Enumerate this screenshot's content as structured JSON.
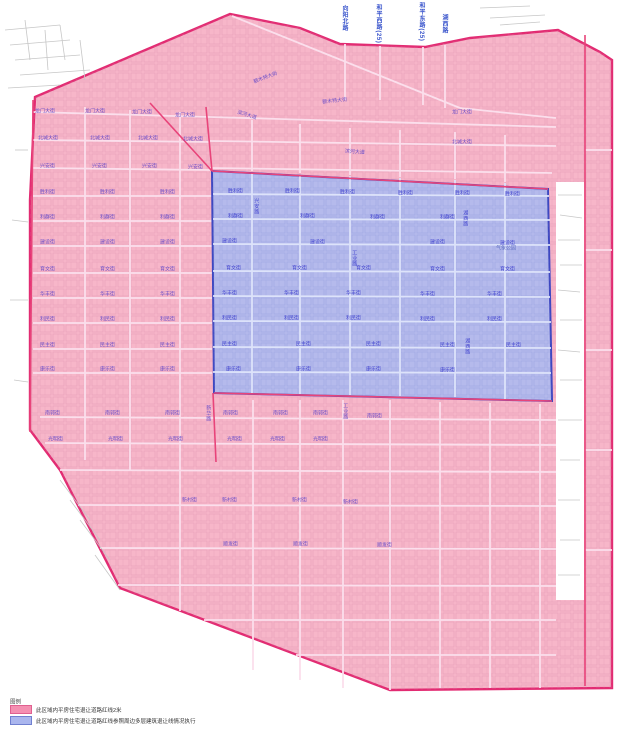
{
  "legend": {
    "title": "图例",
    "items": [
      {
        "label": "此区域内平房住宅退让道路红线2米",
        "color": "#f48fb1",
        "border": "#e06090"
      },
      {
        "label": "此区域内平房住宅退让道路红线参照周边多层建筑退让线情况执行",
        "color": "#aab6ee",
        "border": "#7080d0"
      }
    ]
  },
  "map": {
    "colors": {
      "pink_fill": "#f7b6c9",
      "pink_border": "#e22b72",
      "blue_fill": "#b0bbf0",
      "blue_border": "#2e3ec0",
      "street_label": "#6b4fc8",
      "blue_street_label": "#4345cf",
      "top_road_label": "#3a55cc"
    },
    "regions": {
      "pink_outline": "35,97 230,14 300,28 340,44 425,47 470,38 558,30 600,52 612,60 612,688 390,690 120,588 60,470 30,430 30,200",
      "blue_outline": "212,171 548,189 552,401 214,393",
      "white_notch": "556,182 584,182 584,600 556,600"
    },
    "lines": [
      [
        150,
        103,
        212,
        171,
        "r"
      ],
      [
        212,
        171,
        548,
        189,
        "r"
      ],
      [
        214,
        393,
        552,
        401,
        "r"
      ],
      [
        33,
        100,
        30,
        432,
        "r"
      ],
      [
        206,
        107,
        212,
        171,
        "r"
      ],
      [
        213,
        393,
        216,
        462,
        "r"
      ],
      [
        585,
        35,
        585,
        686,
        "r"
      ],
      [
        232,
        16,
        460,
        108,
        "p"
      ],
      [
        460,
        108,
        556,
        118,
        "p"
      ],
      [
        33,
        112,
        210,
        117,
        "p"
      ],
      [
        210,
        117,
        556,
        127,
        "p"
      ],
      [
        33,
        140,
        210,
        142,
        "p"
      ],
      [
        210,
        141,
        556,
        146,
        "p"
      ],
      [
        33,
        168,
        210,
        170,
        "p"
      ],
      [
        210,
        168,
        552,
        173,
        "p"
      ],
      [
        33,
        196,
        212,
        196,
        "p"
      ],
      [
        33,
        221,
        212,
        221,
        "p"
      ],
      [
        33,
        246,
        212,
        246,
        "p"
      ],
      [
        33,
        273,
        212,
        273,
        "p"
      ],
      [
        33,
        298,
        212,
        298,
        "p"
      ],
      [
        33,
        323,
        212,
        323,
        "p"
      ],
      [
        33,
        349,
        212,
        349,
        "p"
      ],
      [
        33,
        373,
        212,
        373,
        "p"
      ],
      [
        40,
        417,
        556,
        420,
        "p"
      ],
      [
        45,
        443,
        556,
        445,
        "p"
      ],
      [
        60,
        470,
        556,
        472,
        "p"
      ],
      [
        78,
        505,
        556,
        506,
        "p"
      ],
      [
        100,
        548,
        556,
        549,
        "p"
      ],
      [
        118,
        585,
        556,
        586,
        "p"
      ],
      [
        204,
        620,
        556,
        620,
        "p"
      ],
      [
        296,
        655,
        556,
        655,
        "p"
      ],
      [
        85,
        107,
        85,
        460,
        "p"
      ],
      [
        130,
        110,
        130,
        470,
        "p"
      ],
      [
        180,
        112,
        180,
        611,
        "p"
      ],
      [
        345,
        44,
        345,
        100,
        "p"
      ],
      [
        380,
        46,
        380,
        100,
        "p"
      ],
      [
        423,
        47,
        423,
        105,
        "p"
      ],
      [
        445,
        45,
        445,
        108,
        "p"
      ],
      [
        252,
        120,
        252,
        171,
        "p"
      ],
      [
        300,
        124,
        300,
        173,
        "p"
      ],
      [
        350,
        128,
        350,
        175,
        "p"
      ],
      [
        400,
        130,
        400,
        177,
        "p"
      ],
      [
        455,
        132,
        455,
        179,
        "p"
      ],
      [
        505,
        135,
        505,
        182,
        "p"
      ],
      [
        253,
        400,
        253,
        670,
        "p"
      ],
      [
        300,
        400,
        300,
        680,
        "p"
      ],
      [
        343,
        400,
        343,
        688,
        "p"
      ],
      [
        390,
        400,
        390,
        690,
        "p"
      ],
      [
        440,
        402,
        440,
        688,
        "p"
      ],
      [
        490,
        403,
        490,
        688,
        "p"
      ],
      [
        540,
        404,
        540,
        688,
        "p"
      ],
      [
        585,
        150,
        612,
        150,
        "p"
      ],
      [
        585,
        250,
        612,
        250,
        "p"
      ],
      [
        585,
        350,
        612,
        350,
        "p"
      ],
      [
        585,
        450,
        612,
        450,
        "p"
      ],
      [
        585,
        550,
        612,
        550,
        "p"
      ],
      [
        213,
        194,
        549,
        196,
        "b"
      ],
      [
        213,
        219,
        550,
        220,
        "b"
      ],
      [
        213,
        244,
        550,
        245,
        "b"
      ],
      [
        213,
        271,
        550,
        272,
        "b"
      ],
      [
        213,
        296,
        550,
        297,
        "b"
      ],
      [
        213,
        321,
        551,
        322,
        "b"
      ],
      [
        213,
        347,
        551,
        348,
        "b"
      ],
      [
        213,
        372,
        551,
        373,
        "b"
      ],
      [
        252,
        173,
        252,
        393,
        "b"
      ],
      [
        300,
        175,
        300,
        394,
        "b"
      ],
      [
        350,
        176,
        350,
        395,
        "b"
      ],
      [
        400,
        178,
        400,
        396,
        "b"
      ],
      [
        455,
        180,
        455,
        397,
        "b"
      ],
      [
        505,
        183,
        505,
        399,
        "b"
      ],
      [
        5,
        30,
        60,
        25,
        "g"
      ],
      [
        10,
        45,
        70,
        40,
        "g"
      ],
      [
        15,
        60,
        80,
        55,
        "g"
      ],
      [
        20,
        75,
        90,
        70,
        "g"
      ],
      [
        8,
        88,
        60,
        85,
        "g"
      ],
      [
        60,
        25,
        65,
        60,
        "g"
      ],
      [
        80,
        40,
        85,
        80,
        "g"
      ],
      [
        25,
        20,
        30,
        60,
        "g"
      ],
      [
        45,
        30,
        48,
        70,
        "g"
      ],
      [
        15,
        150,
        28,
        150,
        "g"
      ],
      [
        12,
        220,
        28,
        222,
        "g"
      ],
      [
        10,
        300,
        28,
        300,
        "g"
      ],
      [
        14,
        380,
        28,
        382,
        "g"
      ],
      [
        558,
        195,
        582,
        195,
        "g"
      ],
      [
        560,
        215,
        582,
        218,
        "g"
      ],
      [
        558,
        240,
        580,
        240,
        "g"
      ],
      [
        560,
        265,
        582,
        265,
        "g"
      ],
      [
        558,
        290,
        580,
        292,
        "g"
      ],
      [
        560,
        320,
        582,
        320,
        "g"
      ],
      [
        558,
        350,
        580,
        352,
        "g"
      ],
      [
        560,
        380,
        582,
        380,
        "g"
      ],
      [
        558,
        420,
        582,
        420,
        "g"
      ],
      [
        560,
        460,
        580,
        460,
        "g"
      ],
      [
        558,
        500,
        580,
        500,
        "g"
      ],
      [
        560,
        540,
        580,
        540,
        "g"
      ],
      [
        558,
        575,
        580,
        575,
        "g"
      ],
      [
        480,
        8,
        530,
        6,
        "g"
      ],
      [
        490,
        18,
        545,
        15,
        "g"
      ],
      [
        500,
        25,
        540,
        22,
        "g"
      ],
      [
        70,
        500,
        100,
        540,
        "g"
      ],
      [
        80,
        520,
        110,
        560,
        "g"
      ],
      [
        95,
        555,
        120,
        590,
        "g"
      ],
      [
        60,
        480,
        90,
        520,
        "g"
      ]
    ],
    "labels": [
      [
        "向阳北路",
        341,
        5,
        "t"
      ],
      [
        "和平西路(25)",
        375,
        4,
        "t"
      ],
      [
        "和平东路(25)",
        418,
        2,
        "t"
      ],
      [
        "湖西路",
        441,
        14,
        "t"
      ],
      [
        "额木特大街",
        253,
        80,
        "s",
        -21
      ],
      [
        "额木特大街",
        322,
        100,
        "s",
        -6
      ],
      [
        "滨河大道",
        238,
        110,
        "s",
        17
      ],
      [
        "滨河大道",
        345,
        149,
        "s",
        4
      ],
      [
        "龙门大街",
        35,
        109,
        "s"
      ],
      [
        "龙门大街",
        85,
        109,
        "s"
      ],
      [
        "龙门大街",
        132,
        110,
        "s"
      ],
      [
        "龙门大街",
        175,
        113,
        "s"
      ],
      [
        "龙门大街",
        452,
        110,
        "s"
      ],
      [
        "北城大街",
        38,
        136,
        "s"
      ],
      [
        "北城大街",
        90,
        136,
        "s"
      ],
      [
        "北城大街",
        138,
        136,
        "s"
      ],
      [
        "北城大街",
        183,
        137,
        "s"
      ],
      [
        "北城大街",
        452,
        140,
        "s"
      ],
      [
        "兴安街",
        40,
        164,
        "s"
      ],
      [
        "兴安街",
        92,
        164,
        "s"
      ],
      [
        "兴安街",
        142,
        164,
        "s"
      ],
      [
        "兴安街",
        188,
        165,
        "s"
      ],
      [
        "胜利街",
        40,
        190,
        "s"
      ],
      [
        "胜利街",
        100,
        190,
        "s"
      ],
      [
        "胜利街",
        160,
        190,
        "s"
      ],
      [
        "利群街",
        40,
        215,
        "s"
      ],
      [
        "利群街",
        100,
        215,
        "s"
      ],
      [
        "利群街",
        160,
        215,
        "s"
      ],
      [
        "建设街",
        40,
        240,
        "s"
      ],
      [
        "建设街",
        100,
        240,
        "s"
      ],
      [
        "建设街",
        160,
        240,
        "s"
      ],
      [
        "育文街",
        40,
        267,
        "s"
      ],
      [
        "育文街",
        100,
        267,
        "s"
      ],
      [
        "育文街",
        160,
        267,
        "s"
      ],
      [
        "华丰街",
        40,
        292,
        "s"
      ],
      [
        "华丰街",
        100,
        292,
        "s"
      ],
      [
        "华丰街",
        160,
        292,
        "s"
      ],
      [
        "利民街",
        40,
        317,
        "s"
      ],
      [
        "利民街",
        100,
        317,
        "s"
      ],
      [
        "利民街",
        160,
        317,
        "s"
      ],
      [
        "民主街",
        40,
        343,
        "s"
      ],
      [
        "民主街",
        100,
        343,
        "s"
      ],
      [
        "民主街",
        160,
        343,
        "s"
      ],
      [
        "康乐街",
        40,
        367,
        "s"
      ],
      [
        "康乐街",
        100,
        367,
        "s"
      ],
      [
        "康乐街",
        160,
        367,
        "s"
      ],
      [
        "南郭街",
        45,
        411,
        "s"
      ],
      [
        "南郭街",
        105,
        411,
        "s"
      ],
      [
        "南郭街",
        165,
        411,
        "s"
      ],
      [
        "南郭街",
        223,
        411,
        "s"
      ],
      [
        "南郭街",
        273,
        411,
        "s"
      ],
      [
        "南郭街",
        313,
        411,
        "s"
      ],
      [
        "南郭街",
        367,
        414,
        "s"
      ],
      [
        "光明街",
        48,
        437,
        "s"
      ],
      [
        "光明街",
        108,
        437,
        "s"
      ],
      [
        "光明街",
        168,
        437,
        "s"
      ],
      [
        "光明街",
        227,
        437,
        "s"
      ],
      [
        "光明街",
        270,
        437,
        "s"
      ],
      [
        "光明街",
        313,
        437,
        "s"
      ],
      [
        "新村街",
        182,
        498,
        "s"
      ],
      [
        "新村街",
        222,
        498,
        "s"
      ],
      [
        "新村街",
        292,
        498,
        "s"
      ],
      [
        "新村街",
        343,
        500,
        "s"
      ],
      [
        "顺发街",
        223,
        542,
        "s"
      ],
      [
        "顺发街",
        293,
        542,
        "s"
      ],
      [
        "顺发街",
        377,
        543,
        "s"
      ],
      [
        "新华路",
        205,
        405,
        "sv"
      ],
      [
        "工业路",
        342,
        403,
        "sv"
      ],
      [
        "胜利街",
        228,
        189,
        "b"
      ],
      [
        "胜利街",
        285,
        189,
        "b"
      ],
      [
        "胜利街",
        340,
        190,
        "b"
      ],
      [
        "胜利街",
        398,
        191,
        "b"
      ],
      [
        "胜利街",
        455,
        191,
        "b"
      ],
      [
        "胜利街",
        505,
        192,
        "b"
      ],
      [
        "利群街",
        228,
        214,
        "b"
      ],
      [
        "利群街",
        300,
        214,
        "b"
      ],
      [
        "利群街",
        370,
        215,
        "b"
      ],
      [
        "利群街",
        440,
        215,
        "b"
      ],
      [
        "建设街",
        222,
        239,
        "b"
      ],
      [
        "建设街",
        310,
        240,
        "b"
      ],
      [
        "建设街",
        430,
        240,
        "b"
      ],
      [
        "建设街",
        500,
        241,
        "b"
      ],
      [
        "育文街",
        226,
        266,
        "b"
      ],
      [
        "育文街",
        292,
        266,
        "b"
      ],
      [
        "育文街",
        356,
        266,
        "b"
      ],
      [
        "育文街",
        430,
        267,
        "b"
      ],
      [
        "育文街",
        500,
        267,
        "b"
      ],
      [
        "华丰街",
        222,
        291,
        "b"
      ],
      [
        "华丰街",
        284,
        291,
        "b"
      ],
      [
        "华丰街",
        346,
        291,
        "b"
      ],
      [
        "华丰街",
        420,
        292,
        "b"
      ],
      [
        "华丰街",
        487,
        292,
        "b"
      ],
      [
        "利民街",
        222,
        316,
        "b"
      ],
      [
        "利民街",
        284,
        316,
        "b"
      ],
      [
        "利民街",
        346,
        316,
        "b"
      ],
      [
        "利民街",
        420,
        317,
        "b"
      ],
      [
        "利民街",
        487,
        317,
        "b"
      ],
      [
        "民主街",
        222,
        342,
        "b"
      ],
      [
        "民主街",
        296,
        342,
        "b"
      ],
      [
        "民主街",
        366,
        342,
        "b"
      ],
      [
        "民主街",
        440,
        343,
        "b"
      ],
      [
        "民主街",
        506,
        343,
        "b"
      ],
      [
        "康乐街",
        226,
        367,
        "b"
      ],
      [
        "康乐街",
        296,
        367,
        "b"
      ],
      [
        "康乐街",
        366,
        367,
        "b"
      ],
      [
        "康乐街",
        440,
        368,
        "b"
      ],
      [
        "兴安路",
        253,
        198,
        "bv"
      ],
      [
        "工业路",
        351,
        250,
        "bv"
      ],
      [
        "湖西路",
        462,
        210,
        "bv"
      ],
      [
        "湖西路",
        464,
        338,
        "bv"
      ],
      [
        "气象公园",
        496,
        246,
        "n"
      ]
    ]
  }
}
